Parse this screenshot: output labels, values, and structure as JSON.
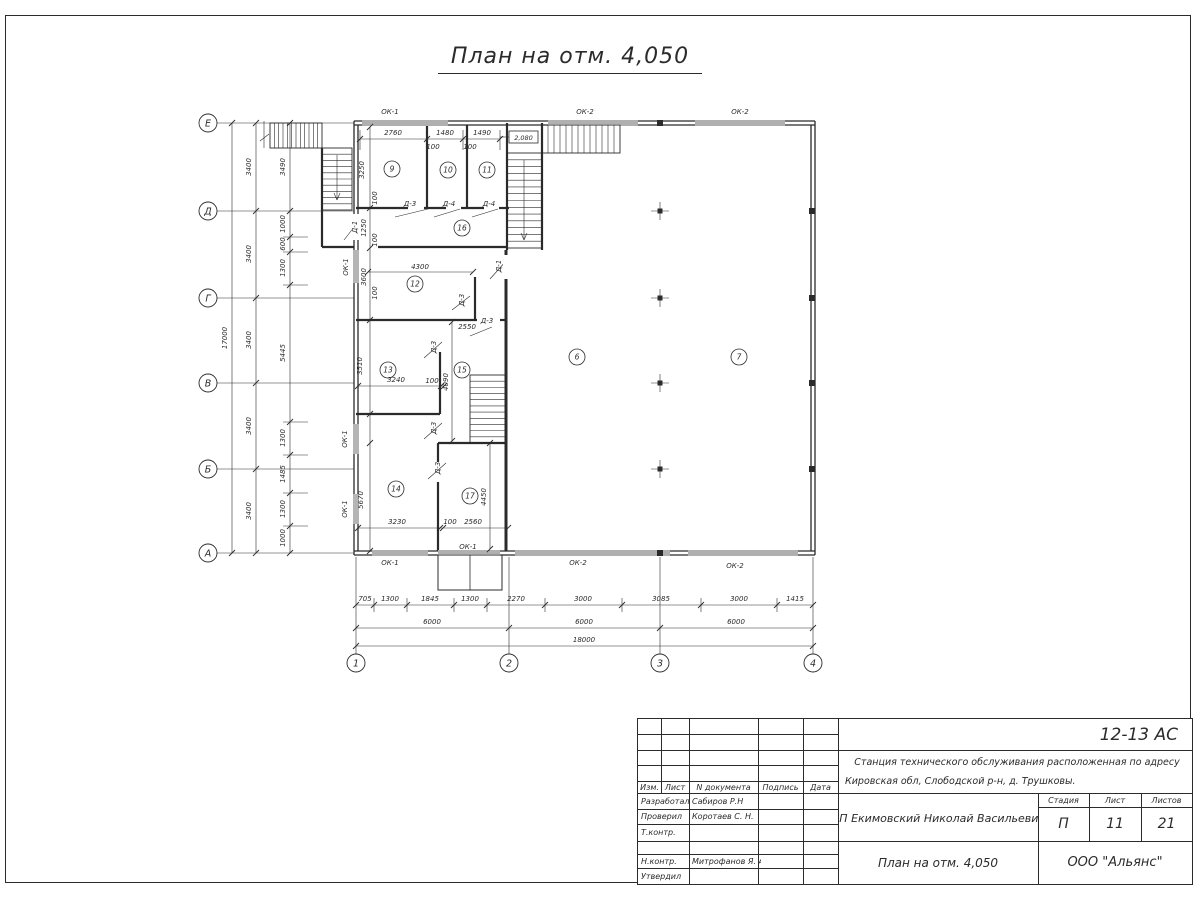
{
  "sheet": {
    "title": "План на отм. 4,050"
  },
  "stamp": {
    "doc_number": "12-13 АС",
    "project_line1": "Станция технического обслуживания расположенная по адресу",
    "project_line2": "Кировская обл, Слободской р-н, д. Трушковы.",
    "client": "ИП Екимовский Николай Васильевич",
    "sheet_title": "План на отм. 4,050",
    "organization": "ООО \"Альянс\"",
    "headers": {
      "izm": "Изм.",
      "list": "Лист",
      "doc": "N документа",
      "sign": "Подпись",
      "date": "Дата",
      "stage": "Стадия",
      "sheet": "Лист",
      "sheets": "Листов"
    },
    "stage_value": "П",
    "sheet_value": "11",
    "sheets_value": "21",
    "rows": [
      {
        "role": "Разработал",
        "name": "Сабиров Р.Н"
      },
      {
        "role": "Проверил",
        "name": "Коротаев С. Н."
      },
      {
        "role": "Т.контр.",
        "name": ""
      },
      {
        "role": "",
        "name": ""
      },
      {
        "role": "Н.контр.",
        "name": "Митрофанов Я. А."
      },
      {
        "role": "Утвердил",
        "name": ""
      }
    ]
  },
  "plan": {
    "ink": "#2b2b2b",
    "level_mark": {
      "text": "2,080",
      "box": [
        509,
        131,
        29,
        12
      ]
    },
    "axis_bubbles_bottom": [
      [
        "1",
        356,
        663
      ],
      [
        "2",
        509,
        663
      ],
      [
        "3",
        660,
        663
      ],
      [
        "4",
        813,
        663
      ]
    ],
    "axis_bubbles_left": [
      [
        "Е",
        208,
        123
      ],
      [
        "Д",
        208,
        211
      ],
      [
        "Г",
        208,
        298
      ],
      [
        "В",
        208,
        383
      ],
      [
        "Б",
        208,
        469
      ],
      [
        "А",
        208,
        553
      ]
    ],
    "room_bubbles": [
      [
        "9",
        392,
        169
      ],
      [
        "10",
        448,
        170
      ],
      [
        "11",
        487,
        170
      ],
      [
        "16",
        462,
        228
      ],
      [
        "12",
        415,
        284
      ],
      [
        "13",
        388,
        370
      ],
      [
        "15",
        462,
        370
      ],
      [
        "14",
        396,
        489
      ],
      [
        "17",
        470,
        496
      ],
      [
        "6",
        577,
        357
      ],
      [
        "7",
        739,
        357
      ]
    ],
    "texts": [
      [
        "17000",
        227,
        338,
        1
      ],
      [
        "3400",
        251,
        167,
        1
      ],
      [
        "3400",
        251,
        254,
        1
      ],
      [
        "3400",
        251,
        340,
        1
      ],
      [
        "3400",
        251,
        426,
        1
      ],
      [
        "3400",
        251,
        511,
        1
      ],
      [
        "3490",
        285,
        167,
        1
      ],
      [
        "1000",
        285,
        224,
        1
      ],
      [
        "600",
        285,
        244,
        1
      ],
      [
        "1300",
        285,
        268,
        1
      ],
      [
        "5445",
        285,
        353,
        1
      ],
      [
        "1300",
        285,
        438,
        1
      ],
      [
        "1485",
        285,
        474,
        1
      ],
      [
        "1300",
        285,
        509,
        1
      ],
      [
        "1000",
        285,
        538,
        1
      ],
      [
        "705",
        365,
        601
      ],
      [
        "1300",
        390,
        601
      ],
      [
        "1845",
        430,
        601
      ],
      [
        "1300",
        470,
        601
      ],
      [
        "2270",
        516,
        601
      ],
      [
        "3000",
        583,
        601
      ],
      [
        "3085",
        661,
        601
      ],
      [
        "3000",
        739,
        601
      ],
      [
        "1415",
        795,
        601
      ],
      [
        "6000",
        432,
        624
      ],
      [
        "6000",
        584,
        624
      ],
      [
        "6000",
        736,
        624
      ],
      [
        "18000",
        584,
        642
      ],
      [
        "2760",
        393,
        135
      ],
      [
        "1480",
        445,
        135
      ],
      [
        "1490",
        482,
        135
      ],
      [
        "100",
        433,
        149
      ],
      [
        "100",
        470,
        149
      ],
      [
        "3250",
        364,
        170,
        1
      ],
      [
        "100",
        377,
        198,
        1
      ],
      [
        "1250",
        366,
        228,
        1
      ],
      [
        "100",
        377,
        240,
        1
      ],
      [
        "3600",
        366,
        277,
        1
      ],
      [
        "100",
        377,
        293,
        1
      ],
      [
        "4300",
        420,
        269
      ],
      [
        "2550",
        467,
        329
      ],
      [
        "3510",
        362,
        366,
        1
      ],
      [
        "3240",
        396,
        382
      ],
      [
        "100",
        432,
        383
      ],
      [
        "4090",
        448,
        382,
        1
      ],
      [
        "5670",
        363,
        500,
        1
      ],
      [
        "3230",
        397,
        524
      ],
      [
        "100",
        450,
        524
      ],
      [
        "2560",
        473,
        524
      ],
      [
        "4450",
        486,
        497,
        1
      ]
    ],
    "window_labels": [
      [
        "ОК-1",
        390,
        114
      ],
      [
        "ОК-2",
        585,
        114
      ],
      [
        "ОК-2",
        740,
        114
      ],
      [
        "ОК-1",
        348,
        267,
        1
      ],
      [
        "ОК-1",
        347,
        439,
        1
      ],
      [
        "ОК-1",
        347,
        509,
        1
      ],
      [
        "ОК-1",
        390,
        565
      ],
      [
        "ОК-1",
        468,
        549
      ],
      [
        "ОК-2",
        578,
        565
      ],
      [
        "ОК-2",
        735,
        568
      ]
    ],
    "door_labels": [
      [
        "Д-3",
        410,
        206
      ],
      [
        "Д-4",
        449,
        206
      ],
      [
        "Д-4",
        489,
        206
      ],
      [
        "Д-1",
        357,
        227,
        1
      ],
      [
        "Д-1",
        501,
        266,
        1
      ],
      [
        "Д-3",
        464,
        300,
        1
      ],
      [
        "Д-3",
        487,
        323
      ],
      [
        "Д-3",
        436,
        347,
        1
      ],
      [
        "Д-3",
        436,
        428,
        1
      ],
      [
        "Д-3",
        440,
        468,
        1
      ]
    ],
    "walls": [
      [
        354,
        121,
        815,
        121,
        1.3
      ],
      [
        354,
        125,
        815,
        125,
        1.3
      ],
      [
        354,
        551,
        815,
        551,
        1.3
      ],
      [
        354,
        555,
        815,
        555,
        1.3
      ],
      [
        354,
        121,
        354,
        555,
        1.3
      ],
      [
        358,
        125,
        358,
        551,
        1.3
      ],
      [
        815,
        121,
        815,
        555,
        1.3
      ],
      [
        811,
        125,
        811,
        551,
        1.3
      ],
      [
        356,
        208,
        408,
        208,
        2.2
      ],
      [
        424,
        208,
        446,
        208,
        2.2
      ],
      [
        461,
        208,
        484,
        208,
        2.2
      ],
      [
        499,
        208,
        509,
        208,
        2.2
      ],
      [
        427,
        125,
        427,
        208,
        2.2
      ],
      [
        467,
        125,
        467,
        208,
        2.2
      ],
      [
        378,
        247,
        507,
        247,
        2.2
      ],
      [
        507,
        123,
        507,
        250,
        2.2
      ],
      [
        542,
        123,
        542,
        250,
        2.2
      ],
      [
        506,
        250,
        506,
        551,
        3
      ],
      [
        356,
        320,
        477,
        320,
        2.2
      ],
      [
        500,
        320,
        506,
        320,
        2.2
      ],
      [
        475,
        277,
        475,
        320,
        2.2
      ],
      [
        440,
        352,
        440,
        414,
        2.2
      ],
      [
        356,
        414,
        440,
        414,
        2.2
      ],
      [
        438,
        443,
        507,
        443,
        2.2
      ],
      [
        438,
        443,
        438,
        462,
        2.2
      ],
      [
        438,
        482,
        438,
        551,
        2.2
      ],
      [
        322,
        148,
        322,
        247,
        2.2
      ],
      [
        322,
        247,
        354,
        247,
        2.2
      ]
    ],
    "door_gaps": [
      [
        352,
        214,
        8,
        26
      ],
      [
        503,
        255,
        7,
        24
      ]
    ],
    "windows": [
      {
        "o": "h",
        "a": 123,
        "f": 362,
        "t": 448
      },
      {
        "o": "h",
        "a": 123,
        "f": 548,
        "t": 638
      },
      {
        "o": "h",
        "a": 123,
        "f": 695,
        "t": 785
      },
      {
        "o": "h",
        "a": 553,
        "f": 372,
        "t": 428
      },
      {
        "o": "h",
        "a": 553,
        "f": 438,
        "t": 500
      },
      {
        "o": "h",
        "a": 553,
        "f": 515,
        "t": 670
      },
      {
        "o": "h",
        "a": 553,
        "f": 688,
        "t": 798
      },
      {
        "o": "v",
        "a": 356,
        "f": 250,
        "t": 283
      },
      {
        "o": "v",
        "a": 356,
        "f": 424,
        "t": 454
      },
      {
        "o": "v",
        "a": 356,
        "f": 494,
        "t": 524
      }
    ],
    "stairs": [
      {
        "x": 270,
        "y": 123,
        "w": 52,
        "h": 25,
        "d": "v",
        "n": 12
      },
      {
        "x": 322,
        "y": 148,
        "w": 30,
        "h": 62,
        "d": "h",
        "n": 10
      },
      {
        "x": 507,
        "y": 153,
        "w": 35,
        "h": 95,
        "d": "h",
        "n": 14
      },
      {
        "x": 542,
        "y": 125,
        "w": 78,
        "h": 28,
        "d": "v",
        "n": 13
      },
      {
        "x": 470,
        "y": 375,
        "w": 35,
        "h": 68,
        "d": "h",
        "n": 11
      }
    ],
    "columns_cross": [
      [
        660,
        211
      ],
      [
        660,
        298
      ],
      [
        660,
        383
      ],
      [
        660,
        469
      ]
    ],
    "columns_square": [
      [
        660,
        123
      ],
      [
        660,
        553
      ],
      [
        812,
        211
      ],
      [
        812,
        298
      ],
      [
        812,
        383
      ],
      [
        812,
        469
      ]
    ],
    "porch": {
      "rect": [
        438,
        555,
        64,
        35
      ],
      "divider": [
        470,
        555,
        470,
        590
      ]
    },
    "thin_lines": [
      [
        216,
        123,
        354,
        123
      ],
      [
        216,
        211,
        354,
        211
      ],
      [
        216,
        298,
        354,
        298
      ],
      [
        216,
        383,
        354,
        383
      ],
      [
        216,
        469,
        354,
        469
      ],
      [
        216,
        553,
        354,
        553
      ],
      [
        356,
        557,
        356,
        654
      ],
      [
        509,
        557,
        509,
        654
      ],
      [
        660,
        557,
        660,
        654
      ],
      [
        813,
        557,
        813,
        654
      ],
      [
        232,
        123,
        232,
        553
      ],
      [
        256,
        123,
        256,
        553
      ],
      [
        290,
        123,
        290,
        553
      ],
      [
        356,
        605,
        813,
        605
      ],
      [
        356,
        628,
        813,
        628
      ],
      [
        356,
        646,
        813,
        646
      ],
      [
        360,
        139,
        500,
        139
      ],
      [
        368,
        272,
        473,
        272
      ],
      [
        358,
        386,
        444,
        386
      ],
      [
        358,
        528,
        508,
        528
      ],
      [
        370,
        127,
        370,
        551
      ],
      [
        452,
        322,
        452,
        441
      ],
      [
        490,
        443,
        490,
        549
      ],
      [
        374,
        598,
        374,
        612
      ],
      [
        407,
        598,
        407,
        612
      ],
      [
        454,
        598,
        454,
        612
      ],
      [
        487,
        598,
        487,
        612
      ],
      [
        545,
        598,
        545,
        612
      ],
      [
        622,
        598,
        622,
        612
      ],
      [
        701,
        598,
        701,
        612
      ],
      [
        777,
        598,
        777,
        612
      ],
      [
        283,
        237,
        308,
        237
      ],
      [
        283,
        252,
        308,
        252
      ],
      [
        283,
        285,
        308,
        285
      ],
      [
        283,
        422,
        308,
        422
      ],
      [
        283,
        455,
        308,
        455
      ],
      [
        283,
        493,
        308,
        493
      ],
      [
        283,
        526,
        308,
        526
      ],
      [
        360,
        130,
        360,
        150
      ],
      [
        427,
        130,
        427,
        150
      ],
      [
        463,
        130,
        463,
        150
      ],
      [
        500,
        130,
        500,
        150
      ],
      [
        524,
        160,
        524,
        240
      ],
      [
        521,
        233,
        524,
        240
      ],
      [
        527,
        233,
        524,
        240
      ],
      [
        337,
        155,
        337,
        200
      ],
      [
        334,
        193,
        337,
        200
      ],
      [
        340,
        193,
        337,
        200
      ],
      [
        264,
        121,
        264,
        148
      ],
      [
        260,
        141,
        269,
        134
      ],
      [
        395,
        217,
        428,
        209
      ],
      [
        434,
        217,
        460,
        209
      ],
      [
        472,
        217,
        498,
        209
      ],
      [
        452,
        310,
        470,
        296
      ],
      [
        470,
        336,
        492,
        327
      ],
      [
        424,
        358,
        442,
        342
      ],
      [
        424,
        439,
        442,
        423
      ],
      [
        428,
        479,
        446,
        463
      ],
      [
        344,
        240,
        358,
        222
      ],
      [
        490,
        279,
        506,
        261
      ],
      [
        500,
        137,
        509,
        137
      ]
    ],
    "ticks": [
      [
        232,
        123
      ],
      [
        232,
        553
      ],
      [
        256,
        123
      ],
      [
        256,
        211
      ],
      [
        256,
        298
      ],
      [
        256,
        383
      ],
      [
        256,
        469
      ],
      [
        256,
        553
      ],
      [
        290,
        123
      ],
      [
        290,
        211
      ],
      [
        290,
        237
      ],
      [
        290,
        252
      ],
      [
        290,
        285
      ],
      [
        290,
        422
      ],
      [
        290,
        455
      ],
      [
        290,
        493
      ],
      [
        290,
        526
      ],
      [
        290,
        553
      ],
      [
        356,
        605
      ],
      [
        374,
        605
      ],
      [
        407,
        605
      ],
      [
        454,
        605
      ],
      [
        487,
        605
      ],
      [
        545,
        605
      ],
      [
        622,
        605
      ],
      [
        701,
        605
      ],
      [
        777,
        605
      ],
      [
        813,
        605
      ],
      [
        356,
        628
      ],
      [
        509,
        628
      ],
      [
        660,
        628
      ],
      [
        813,
        628
      ],
      [
        356,
        646
      ],
      [
        813,
        646
      ],
      [
        360,
        139
      ],
      [
        427,
        139
      ],
      [
        463,
        139
      ],
      [
        500,
        139
      ],
      [
        368,
        272
      ],
      [
        473,
        272
      ],
      [
        358,
        386
      ],
      [
        441,
        386
      ],
      [
        444,
        386
      ],
      [
        358,
        528
      ],
      [
        440,
        528
      ],
      [
        443,
        528
      ],
      [
        508,
        528
      ],
      [
        370,
        127
      ],
      [
        370,
        208
      ],
      [
        370,
        248
      ],
      [
        370,
        320
      ],
      [
        370,
        414
      ],
      [
        370,
        443
      ],
      [
        370,
        551
      ],
      [
        452,
        322
      ],
      [
        452,
        441
      ],
      [
        490,
        443
      ],
      [
        490,
        549
      ]
    ]
  }
}
